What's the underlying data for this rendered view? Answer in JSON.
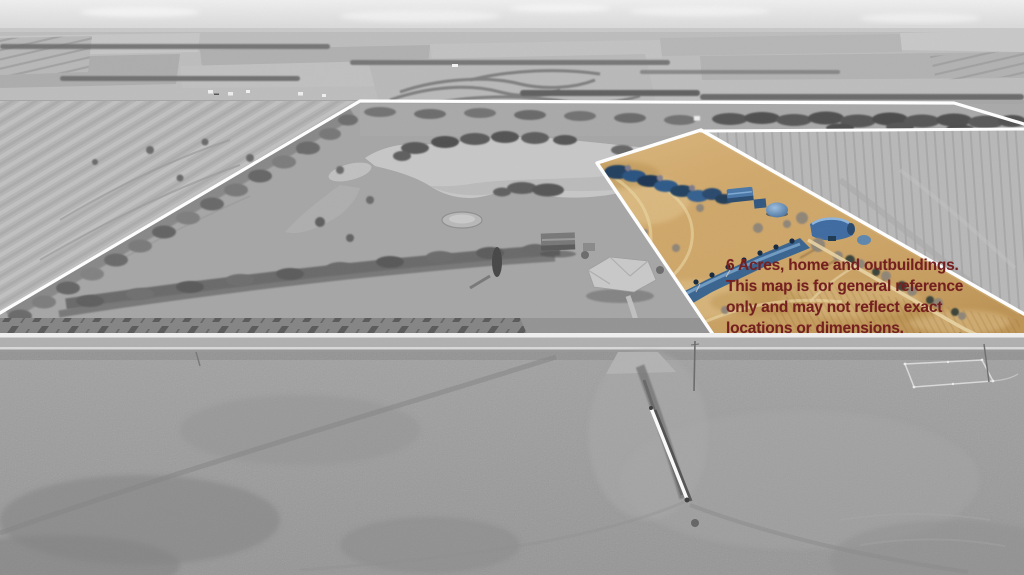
{
  "annotation": {
    "lines": [
      "6 Acres, home and outbuildings.",
      "This map is for general reference",
      "only and may not reflect exact",
      "locations or dimensions."
    ],
    "text_color": "#752020"
  },
  "palette": {
    "boundary_line": "#ffffff",
    "parcel_grass": "#cfa76a",
    "parcel_water": "#39648f",
    "road_asphalt": "#b0b0b0",
    "photo_gray": "#a6a6a6"
  }
}
